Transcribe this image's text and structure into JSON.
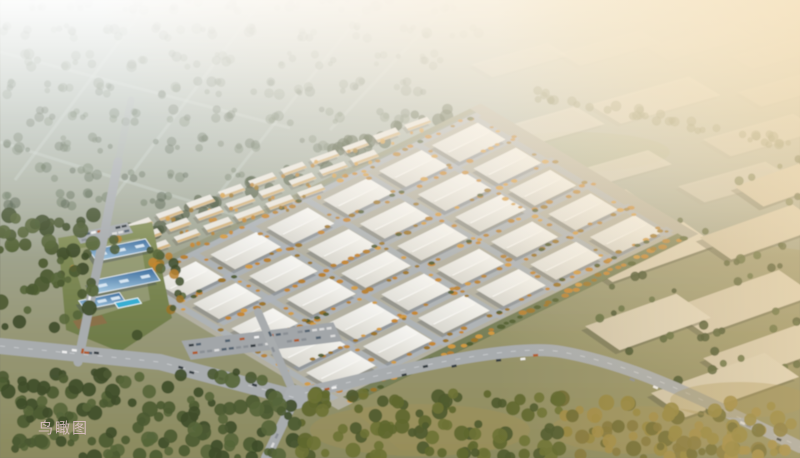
{
  "caption": {
    "text": "鸟瞰图"
  },
  "scene": {
    "kind": "aerial-rendering-industrial-park",
    "park": {
      "warehouse_rows": 5,
      "warehouse_cols": 6
    },
    "right_zone_blocks": 8,
    "residential_rows": 3,
    "palette": {
      "bg_top": "#bfc8c0",
      "bg_mid": "#a2a795",
      "bg_bottom": "#8b8a5e",
      "road": "#a8acae",
      "street": "#aeb4ba",
      "park_ground": "#b3b0a1",
      "warehouse_roof_light": "#f3f2ed",
      "warehouse_roof_dark": "#d9d7cf",
      "warehouse_beige_light": "#e3dac4",
      "warehouse_beige_dark": "#cfc4aa",
      "distant_light": "#efe9dd",
      "distant_dark": "#e6dfd0",
      "blue_roof_dark": "#3f6f9e",
      "blue_roof_light": "#a8cbe2",
      "bronze_roof": "#8a7148",
      "pool": "#38aed2",
      "lawn_light": "#87925c",
      "lawn_dark": "#6d7a48",
      "band_tree": "#3e4b2f",
      "greenbelt": "#5e6b3b",
      "haze_white": "#ffffff",
      "glow_core": "#fff4e0",
      "glow_warm": "#f8e8c8",
      "warm_side": "#e5c486",
      "caption_color": "#dfc3ca",
      "residential_face": "#e9e5dc",
      "residential_warm": "#c9a05e",
      "farm_tree_shades": [
        "#55644c",
        "#4a5843",
        "#64735a"
      ],
      "dark_tree_shades": [
        "#3f4d2a",
        "#4c5a32",
        "#57663a"
      ],
      "mid_tree_shades": [
        "#4f5a2e",
        "#60682f",
        "#6d7234"
      ],
      "gold_tree_shades": [
        "#6e6a32",
        "#82763a",
        "#94853f",
        "#a08b44"
      ],
      "orange_tree_shades": [
        "#c6862e",
        "#d59b3f",
        "#9c7427",
        "#b8812f"
      ],
      "car_colors": [
        "#f0f0f0",
        "#dcdcdc",
        "#51606e",
        "#b05a2a",
        "#8a8f94",
        "#333a40"
      ]
    }
  }
}
